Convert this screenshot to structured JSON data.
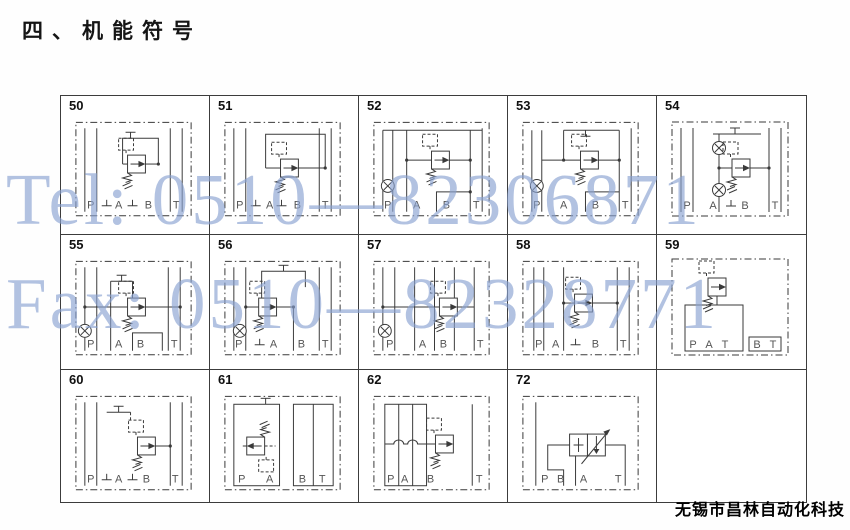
{
  "page": {
    "title": "四、机能符号",
    "footer": "无锡市昌林自动化科技"
  },
  "watermark": {
    "tel": "Tel: 0510—82306871",
    "fax": "Fax: 0510—82328771"
  },
  "colors": {
    "watermark_blue": "#88a2d1",
    "line_dark": "#3a3a3a"
  },
  "grid": {
    "cells": [
      {
        "id": "50",
        "ports": [
          "P",
          "A",
          "B",
          "T"
        ]
      },
      {
        "id": "51",
        "ports": [
          "P",
          "A",
          "B",
          "T"
        ]
      },
      {
        "id": "52",
        "ports": [
          "P",
          "A",
          "B",
          "T"
        ]
      },
      {
        "id": "53",
        "ports": [
          "P",
          "A",
          "B",
          "T"
        ]
      },
      {
        "id": "54",
        "ports": [
          "P",
          "A",
          "B",
          "T"
        ]
      },
      {
        "id": "55",
        "ports": [
          "P",
          "A",
          "B",
          "T"
        ]
      },
      {
        "id": "56",
        "ports": [
          "P",
          "A",
          "B",
          "T"
        ]
      },
      {
        "id": "57",
        "ports": [
          "P",
          "A",
          "B",
          "T"
        ]
      },
      {
        "id": "58",
        "ports": [
          "P",
          "A",
          "B",
          "T"
        ]
      },
      {
        "id": "59",
        "ports": [
          "P",
          "A",
          "T",
          "B",
          "T"
        ]
      },
      {
        "id": "60",
        "ports": [
          "P",
          "A",
          "B",
          "T"
        ]
      },
      {
        "id": "61",
        "ports": [
          "P",
          "A",
          "B",
          "T"
        ]
      },
      {
        "id": "62",
        "ports": [
          "P",
          "A",
          "B",
          "T"
        ]
      },
      {
        "id": "72",
        "ports": [
          "P",
          "B",
          "A",
          "T"
        ]
      }
    ]
  }
}
